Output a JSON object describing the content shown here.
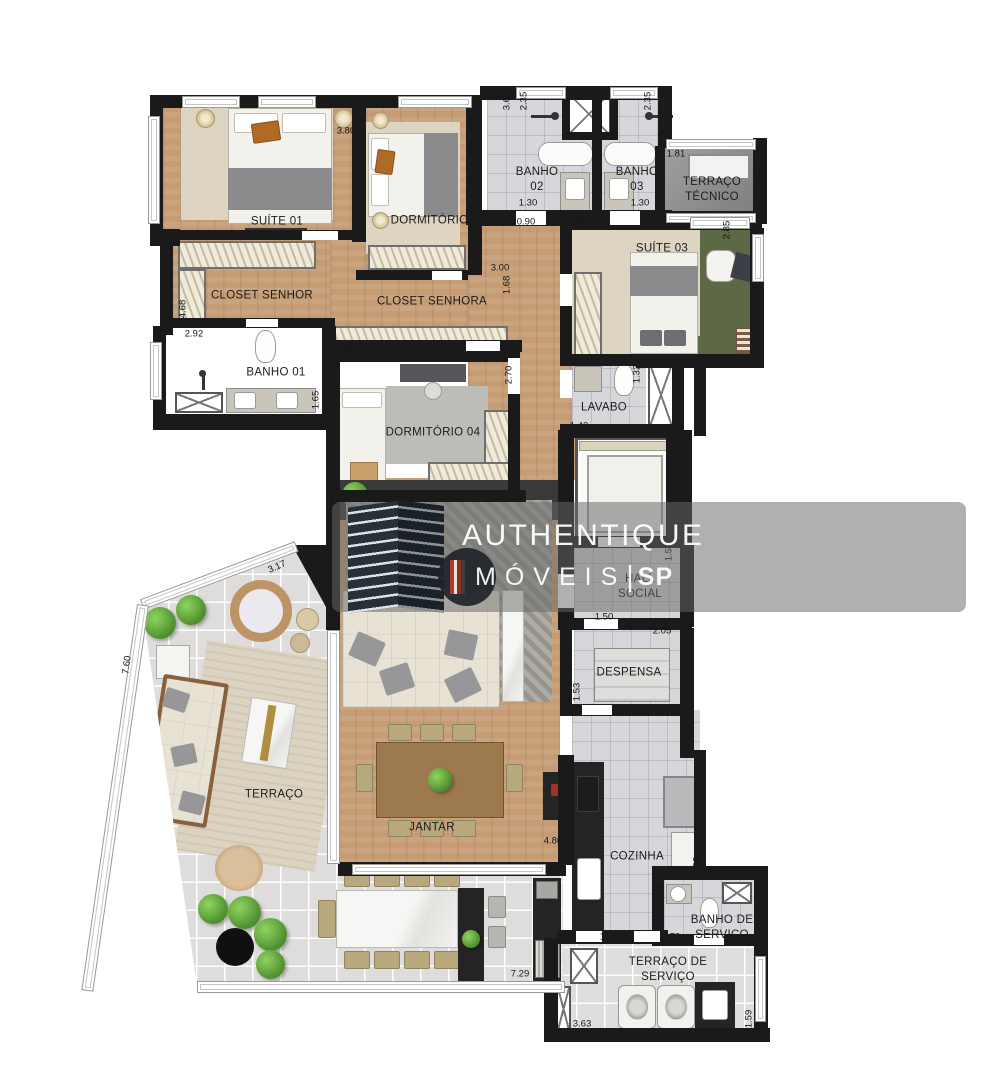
{
  "watermark": {
    "brand": "AUTHENTIQUE",
    "brand2_letters": "MÓVEIS",
    "separator": "|",
    "brand2_suffix": "SP"
  },
  "rooms": {
    "suite01": {
      "label": "SUÍTE 01"
    },
    "dorm02": {
      "label": "DORMITÓRIO 02"
    },
    "banho02": {
      "label": "BANHO 02"
    },
    "banho03": {
      "label": "BANHO 03"
    },
    "terraco_tecnico": {
      "label": "TERRAÇO TÉCNICO"
    },
    "suite03": {
      "label": "SUÍTE 03"
    },
    "closet_senhor": {
      "label": "CLOSET SENHOR"
    },
    "closet_senhora": {
      "label": "CLOSET SENHORA"
    },
    "banho01": {
      "label": "BANHO 01"
    },
    "dorm04": {
      "label": "DORMITÓRIO 04"
    },
    "lavabo": {
      "label": "LAVABO"
    },
    "estar": {
      "label": "ESTAR"
    },
    "hall_social": {
      "label": "HALL SOCIAL"
    },
    "despensa": {
      "label": "DESPENSA"
    },
    "terraco": {
      "label": "TERRAÇO"
    },
    "jantar": {
      "label": "JANTAR"
    },
    "cozinha": {
      "label": "COZINHA"
    },
    "banho_servico": {
      "label": "BANHO DE SERVIÇO"
    },
    "terraco_servico": {
      "label": "TERRAÇO DE SERVIÇO"
    }
  },
  "dims": {
    "d1": "3.80",
    "d2": "3.60",
    "d3": "2.35",
    "d4": "2.35",
    "d5": "1.81",
    "d6": "1.30",
    "d7": "1.30",
    "d8": "0.90",
    "d9": "3.75",
    "d10": "2.85",
    "d11": "3.00",
    "d12": "1.68",
    "d13": "4.68",
    "d14": "2.92",
    "d15": "3.78",
    "d16": "1.65",
    "d17": "2.70",
    "d18": "1.32",
    "d19": "1.40",
    "d20": "7.12",
    "d21": "3.17",
    "d22": "7.60",
    "d23": "1.50",
    "d24": "1.50",
    "d25": "2.05",
    "d26": "1.53",
    "d27": "4.80",
    "d28": "2.09",
    "d29": "1.14",
    "d30": "1.79",
    "d31": "1.79",
    "d32": "7.29",
    "d33": "3.63",
    "d34": "1.59"
  }
}
